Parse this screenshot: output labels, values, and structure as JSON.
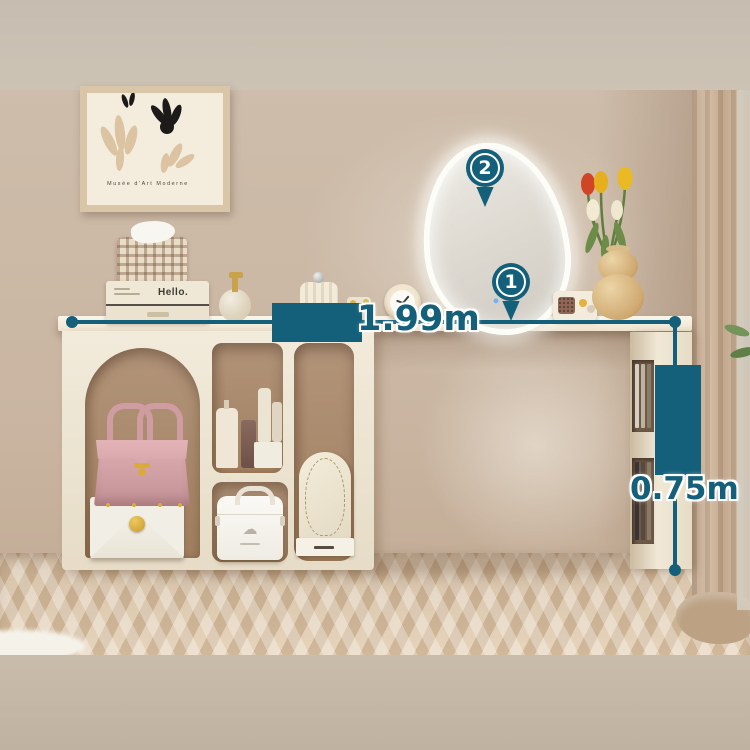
{
  "scene": {
    "type": "furniture-product-photo",
    "subject": "cream vanity dressing table with storage cabinet, irregular LED mirror and side shelf"
  },
  "annotations": {
    "accent_color": "#14607a",
    "width_label": "1.99m",
    "height_label": "0.75m",
    "markers": [
      {
        "number": "1",
        "target": "desk-surface"
      },
      {
        "number": "2",
        "target": "led-mirror"
      }
    ]
  },
  "wall_art": {
    "caption": "Musée d'Art Moderne"
  },
  "desk_items": {
    "storage_box_label": "Hello."
  }
}
